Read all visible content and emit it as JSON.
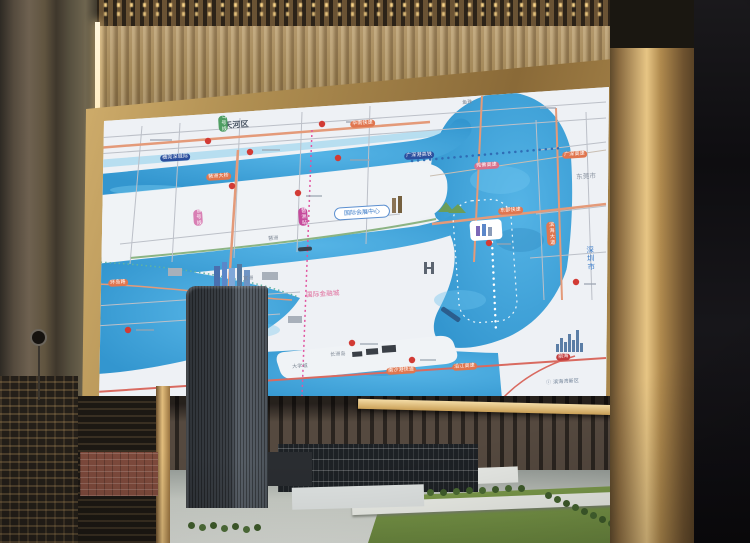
{
  "palette": {
    "water": "#3fa2da",
    "land": "#eef1f5",
    "frame_gold": "#c9a45f",
    "wood_slats": "#a88f66",
    "road_orange": "#e0764f",
    "metro_pink": "#e255a0",
    "led_strip_glow": "#ffe1a0"
  },
  "map": {
    "oval_label": {
      "text": "国际会展中心"
    },
    "region_labels": [
      {
        "text": "天河区",
        "x": 224,
        "y": 122,
        "size": 8,
        "color": "#4a5564",
        "weight": "600"
      },
      {
        "text": "东莞市",
        "x": 576,
        "y": 174,
        "size": 6.5,
        "color": "#8a93a0"
      },
      {
        "text": "深圳市",
        "x": 586,
        "y": 246,
        "size": 7.5,
        "color": "#3a7bc8",
        "vertical": true
      },
      {
        "text": "国际金融城",
        "x": 306,
        "y": 292,
        "size": 6.5,
        "color": "#e06a9a"
      },
      {
        "text": "ⓘ 滨海湾新区",
        "x": 546,
        "y": 380,
        "size": 5,
        "color": "#6d7f95"
      }
    ],
    "small_labels": [
      {
        "text": "琶洲",
        "x": 268,
        "y": 236,
        "color": "#7d8794"
      },
      {
        "text": "官洲",
        "x": 243,
        "y": 276,
        "color": "#7d8794"
      },
      {
        "text": "长洲岛",
        "x": 330,
        "y": 352,
        "color": "#7d8794"
      },
      {
        "text": "大学城",
        "x": 292,
        "y": 364,
        "color": "#7d8794"
      },
      {
        "text": "鱼珠",
        "x": 462,
        "y": 100,
        "color": "#7d8794"
      }
    ],
    "transit_badges": [
      {
        "text": "广深港高铁",
        "x": 404,
        "y": 153,
        "bg": "#2b4f9e"
      },
      {
        "text": "穗莞深城际",
        "x": 160,
        "y": 155,
        "bg": "#2b4f9e"
      },
      {
        "text": "琶洲站",
        "x": 298,
        "y": 208,
        "bg": "#c64a9b",
        "vertical": true
      },
      {
        "text": "8号线",
        "x": 193,
        "y": 210,
        "bg": "#d87fb4",
        "vertical": true
      },
      {
        "text": "7号线",
        "x": 218,
        "y": 116,
        "bg": "#4f9e63",
        "vertical": true
      },
      {
        "text": "前海",
        "x": 556,
        "y": 354,
        "bg": "#c23d3d"
      }
    ],
    "road_badges": [
      {
        "text": "华南快速",
        "x": 350,
        "y": 121
      },
      {
        "text": "琶洲大桥",
        "x": 206,
        "y": 174
      },
      {
        "text": "东部快速",
        "x": 498,
        "y": 208
      },
      {
        "text": "广深高速",
        "x": 562,
        "y": 152
      },
      {
        "text": "莞佛高速",
        "x": 474,
        "y": 163,
        "bg": "#d9708a"
      },
      {
        "text": "环岛路",
        "x": 108,
        "y": 280
      },
      {
        "text": "南沙港快速",
        "x": 386,
        "y": 368
      },
      {
        "text": "沿江高速",
        "x": 452,
        "y": 364
      },
      {
        "text": "滨海大道",
        "x": 546,
        "y": 222,
        "vertical": true
      }
    ]
  }
}
